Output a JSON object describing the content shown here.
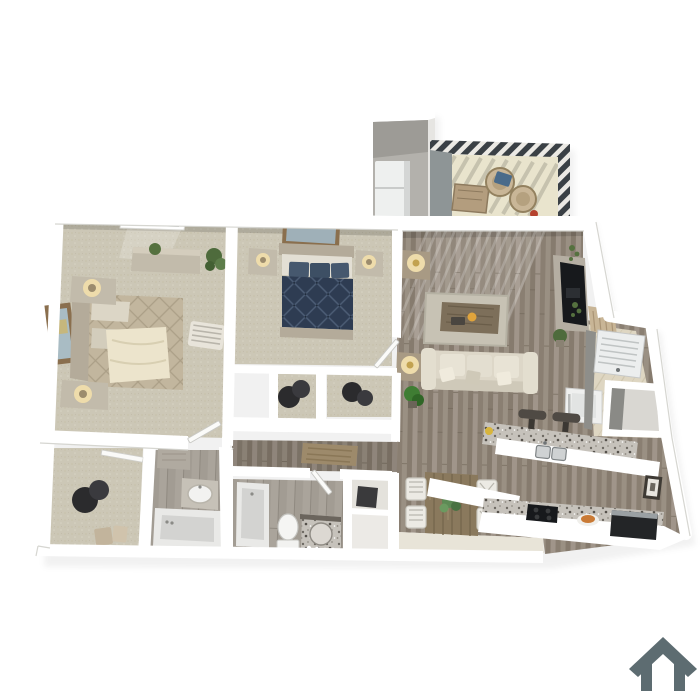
{
  "scene": {
    "kind": "3d-rendered apartment floor plan, top-down perspective view",
    "background": "#ffffff",
    "visible_text": "none"
  },
  "branding": {
    "house_icon": {
      "name": "house-icon",
      "color": "#5d6c71"
    }
  },
  "palette": {
    "wall": "#ffffff",
    "wall_edge": "#d2d1cc",
    "carpet": "#ccc7b6",
    "wood_floor": "#95897b",
    "hall_tint": "#00000018",
    "bath_tile": "#a29c93",
    "balcony_floor": "#e9e4cd",
    "entry_tile": "#ded6c2",
    "granite": "#c6c2bb",
    "navy_bed": "#2e3c52",
    "tan_bed": "#c2b69e",
    "sofa": "#ddd7c8",
    "rug": "#c7c2b4",
    "hall_rug": "#9d8a6b",
    "mat": "#b0976f",
    "tv": "#17191c",
    "railing": "#3a4045",
    "hamper": "#2b2b2d",
    "door_wood": "#c8b596",
    "plant": "#4e6b3c",
    "lamp_glow": "#eedcab",
    "appliance_white": "#eff0ef",
    "tub": "#e9e9e7",
    "interior_shadow": "#8e8e8a"
  },
  "rooms": [
    {
      "id": "master-bedroom",
      "floor": "carpet",
      "furniture": [
        "bed-tan-quilt",
        "headboard",
        "nightstand-upper",
        "nightstand-lower",
        "table-lamps",
        "dresser",
        "window",
        "wall-art",
        "accent-chaise",
        "corner-plant",
        "door-leaf"
      ]
    },
    {
      "id": "bedroom-2",
      "floor": "carpet",
      "furniture": [
        "bed-navy-quilt",
        "pillows",
        "nightstand-left",
        "nightstand-right",
        "table-lamps",
        "wall-art",
        "door-leaf"
      ]
    },
    {
      "id": "bedroom-2-closets",
      "floor": "carpet",
      "furniture": [
        "laundry-hampers"
      ]
    },
    {
      "id": "walk-in-closet",
      "floor": "carpet",
      "furniture": [
        "laundry-hampers",
        "storage-boxes",
        "closet-door-leaf"
      ]
    },
    {
      "id": "master-bathroom",
      "floor": "tile",
      "furniture": [
        "wall-cabinet",
        "vanity-oval-sink",
        "garden-tub"
      ]
    },
    {
      "id": "bathroom-2",
      "floor": "tile",
      "furniture": [
        "tub",
        "toilet",
        "round-granite-vanity",
        "door-leaf"
      ]
    },
    {
      "id": "linen-closets",
      "floor": "vinyl",
      "furniture": [
        "hanging-coats"
      ]
    },
    {
      "id": "hallway",
      "floor": "wood",
      "furniture": [
        "runner-rug"
      ]
    },
    {
      "id": "living-room",
      "floor": "wood",
      "furniture": [
        "sofa",
        "throw-pillows",
        "area-rug",
        "coffee-table",
        "side-table-upper",
        "side-table-lower",
        "brass-lamps",
        "tv-console",
        "tv",
        "wall-scroll-decor",
        "floor-plant",
        "sunlight-stripes"
      ]
    },
    {
      "id": "dining-area",
      "floor": "wood",
      "furniture": [
        "plank-table",
        "chair-1",
        "chair-2",
        "chair-3",
        "chair-4",
        "centerpiece-plant"
      ]
    },
    {
      "id": "kitchen",
      "floor": "wood",
      "furniture": [
        "granite-bar-counter",
        "double-sink",
        "bar-stool-1",
        "bar-stool-2",
        "refrigerator",
        "lower-counter",
        "cooktop",
        "food-plate",
        "dishwasher",
        "framed-art"
      ]
    },
    {
      "id": "entry",
      "floor": "tile",
      "furniture": [
        "front-door-open",
        "doormat"
      ]
    },
    {
      "id": "laundry-closet",
      "furniture": [
        "washer-louvered-door"
      ]
    },
    {
      "id": "entry-closet",
      "furniture": []
    },
    {
      "id": "storage-closet",
      "furniture": [
        "water-heater"
      ]
    },
    {
      "id": "balcony",
      "floor": "concrete",
      "furniture": [
        "deck-railing",
        "wicker-chair-1",
        "wicker-chair-2",
        "patio-table",
        "blue-cushion",
        "red-planter"
      ]
    }
  ]
}
